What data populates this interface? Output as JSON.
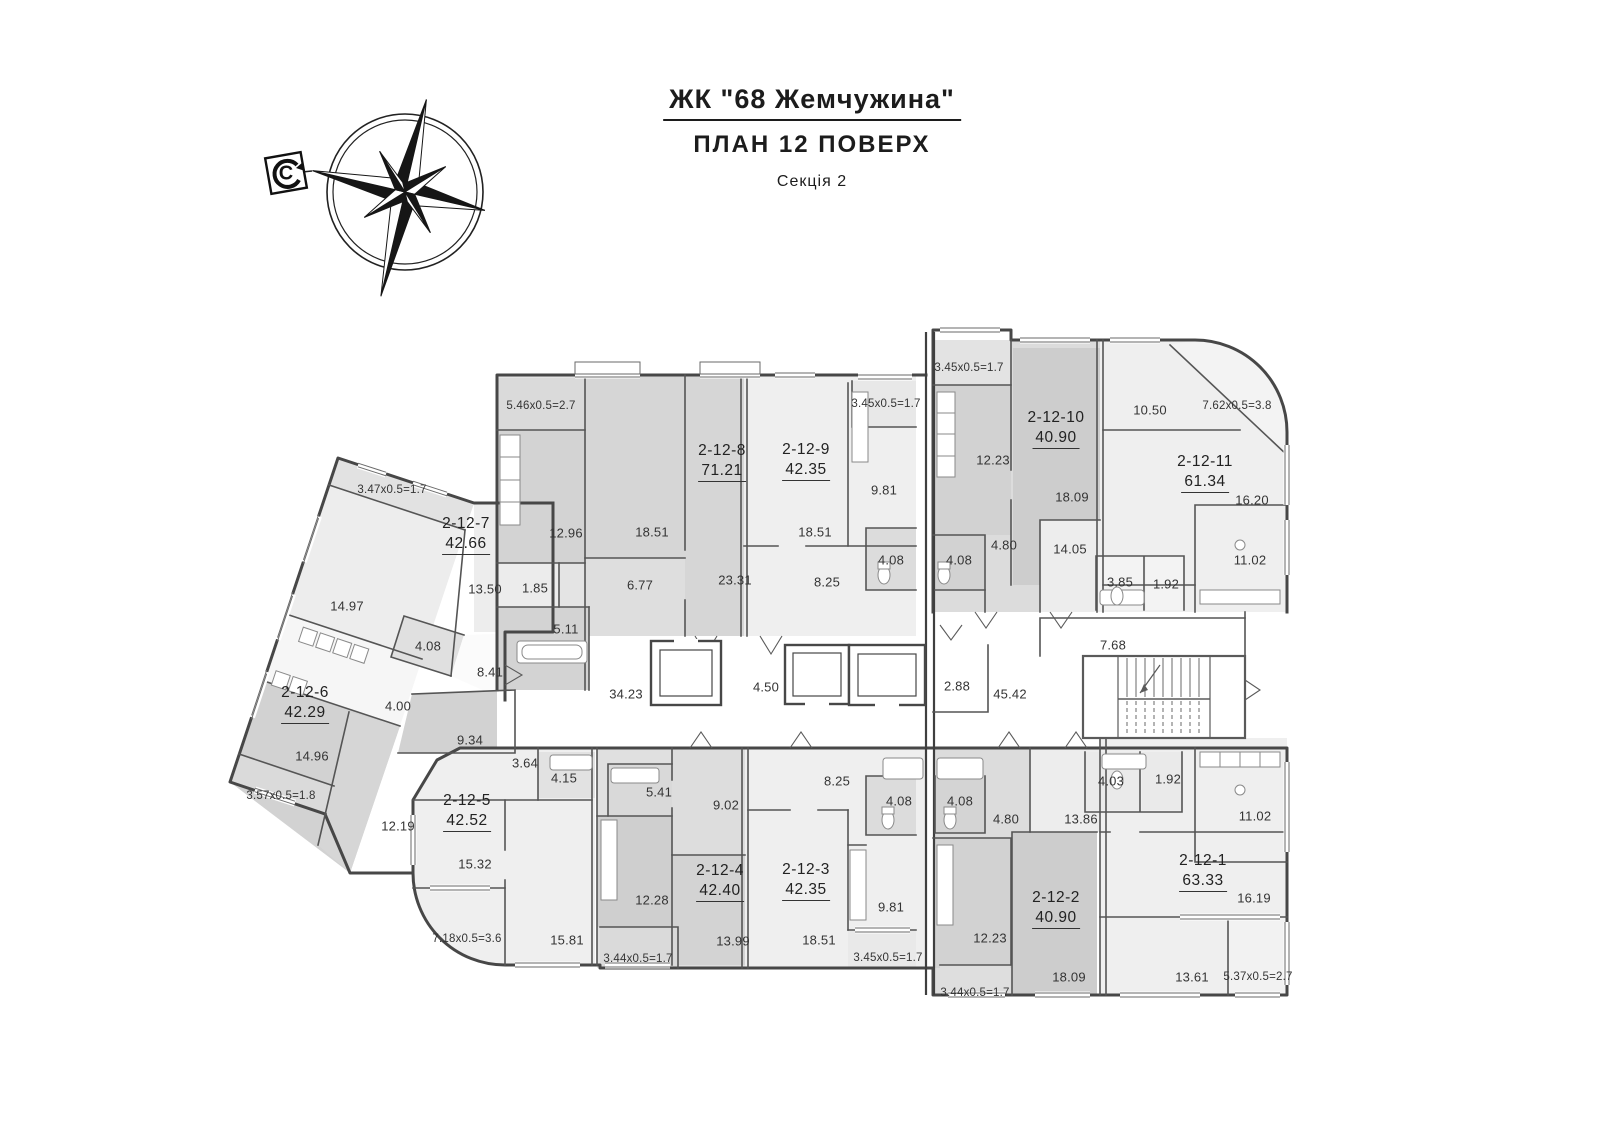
{
  "title": {
    "project": "ЖК \"68 Жемчужина\"",
    "plan": "ПЛАН 12 ПОВЕРХ",
    "section": "Секція 2"
  },
  "compass": {
    "north_label": "С"
  },
  "colors": {
    "wall": "#4a4a4a",
    "room_light": "#efefef",
    "room_mid": "#e0e0e0",
    "room_dark": "#d2d2d2",
    "background": "#ffffff",
    "text": "#343434"
  },
  "common_labels": [
    {
      "v": "34.23",
      "x": 626,
      "y": 694
    },
    {
      "v": "4.50",
      "x": 766,
      "y": 687
    },
    {
      "v": "2.88",
      "x": 957,
      "y": 686
    },
    {
      "v": "45.42",
      "x": 1010,
      "y": 694
    },
    {
      "v": "7.68",
      "x": 1113,
      "y": 645
    }
  ],
  "apartments": [
    {
      "id": "2-12-1",
      "area": "63.33",
      "x": 1203,
      "y": 872,
      "rooms": [
        {
          "v": "13.86",
          "x": 1081,
          "y": 819
        },
        {
          "v": "4.03",
          "x": 1111,
          "y": 781
        },
        {
          "v": "1.92",
          "x": 1168,
          "y": 779
        },
        {
          "v": "11.02",
          "x": 1255,
          "y": 816
        },
        {
          "v": "16.19",
          "x": 1254,
          "y": 898
        },
        {
          "v": "13.61",
          "x": 1192,
          "y": 977
        }
      ],
      "balconies": [
        {
          "v": "5.37x0.5=2.7",
          "x": 1258,
          "y": 977
        }
      ]
    },
    {
      "id": "2-12-2",
      "area": "40.90",
      "x": 1056,
      "y": 909,
      "rooms": [
        {
          "v": "4.08",
          "x": 960,
          "y": 801
        },
        {
          "v": "4.80",
          "x": 1006,
          "y": 819
        },
        {
          "v": "12.23",
          "x": 990,
          "y": 938
        },
        {
          "v": "18.09",
          "x": 1069,
          "y": 977
        }
      ],
      "balconies": [
        {
          "v": "3.44x0.5=1.7",
          "x": 975,
          "y": 993
        }
      ]
    },
    {
      "id": "2-12-3",
      "area": "42.35",
      "x": 806,
      "y": 881,
      "rooms": [
        {
          "v": "8.25",
          "x": 837,
          "y": 781
        },
        {
          "v": "4.08",
          "x": 899,
          "y": 801
        },
        {
          "v": "9.81",
          "x": 891,
          "y": 907
        },
        {
          "v": "18.51",
          "x": 819,
          "y": 940
        }
      ],
      "balconies": [
        {
          "v": "3.45x0.5=1.7",
          "x": 888,
          "y": 958
        }
      ]
    },
    {
      "id": "2-12-4",
      "area": "42.40",
      "x": 720,
      "y": 882,
      "rooms": [
        {
          "v": "5.41",
          "x": 659,
          "y": 792
        },
        {
          "v": "9.02",
          "x": 726,
          "y": 805
        },
        {
          "v": "12.28",
          "x": 652,
          "y": 900
        },
        {
          "v": "13.99",
          "x": 733,
          "y": 941
        }
      ],
      "balconies": [
        {
          "v": "3.44x0.5=1.7",
          "x": 638,
          "y": 959
        }
      ]
    },
    {
      "id": "2-12-5",
      "area": "42.52",
      "x": 467,
      "y": 812,
      "rooms": [
        {
          "v": "3.64",
          "x": 525,
          "y": 763
        },
        {
          "v": "4.15",
          "x": 564,
          "y": 778
        },
        {
          "v": "15.32",
          "x": 475,
          "y": 864
        },
        {
          "v": "15.81",
          "x": 567,
          "y": 940
        }
      ],
      "balconies": [
        {
          "v": "7.18x0.5=3.6",
          "x": 467,
          "y": 939
        }
      ]
    },
    {
      "id": "2-12-6",
      "area": "42.29",
      "x": 305,
      "y": 704,
      "rooms": [
        {
          "v": "4.00",
          "x": 398,
          "y": 706
        },
        {
          "v": "9.34",
          "x": 470,
          "y": 740
        },
        {
          "v": "14.96",
          "x": 312,
          "y": 756
        },
        {
          "v": "12.19",
          "x": 398,
          "y": 826
        }
      ],
      "balconies": [
        {
          "v": "3.57x0.5=1.8",
          "x": 281,
          "y": 796
        }
      ]
    },
    {
      "id": "2-12-7",
      "area": "42.66",
      "x": 466,
      "y": 535,
      "rooms": [
        {
          "v": "14.97",
          "x": 347,
          "y": 606
        },
        {
          "v": "13.50",
          "x": 485,
          "y": 589
        },
        {
          "v": "4.08",
          "x": 428,
          "y": 646
        },
        {
          "v": "8.41",
          "x": 490,
          "y": 672
        }
      ],
      "balconies": [
        {
          "v": "3.47x0.5=1.7",
          "x": 392,
          "y": 490
        }
      ]
    },
    {
      "id": "2-12-8",
      "area": "71.21",
      "x": 722,
      "y": 462,
      "rooms": [
        {
          "v": "12.96",
          "x": 566,
          "y": 533
        },
        {
          "v": "18.51",
          "x": 652,
          "y": 532
        },
        {
          "v": "1.85",
          "x": 535,
          "y": 588
        },
        {
          "v": "5.11",
          "x": 566,
          "y": 629
        },
        {
          "v": "6.77",
          "x": 640,
          "y": 585
        },
        {
          "v": "23.31",
          "x": 735,
          "y": 580
        }
      ],
      "balconies": [
        {
          "v": "5.46x0.5=2.7",
          "x": 541,
          "y": 406
        }
      ]
    },
    {
      "id": "2-12-9",
      "area": "42.35",
      "x": 806,
      "y": 461,
      "rooms": [
        {
          "v": "18.51",
          "x": 815,
          "y": 532
        },
        {
          "v": "9.81",
          "x": 884,
          "y": 490
        },
        {
          "v": "4.08",
          "x": 891,
          "y": 560
        },
        {
          "v": "8.25",
          "x": 827,
          "y": 582
        }
      ],
      "balconies": [
        {
          "v": "3.45x0.5=1.7",
          "x": 886,
          "y": 404
        }
      ]
    },
    {
      "id": "2-12-10",
      "area": "40.90",
      "x": 1056,
      "y": 429,
      "rooms": [
        {
          "v": "12.23",
          "x": 993,
          "y": 460
        },
        {
          "v": "18.09",
          "x": 1072,
          "y": 497
        },
        {
          "v": "4.08",
          "x": 959,
          "y": 560
        },
        {
          "v": "4.80",
          "x": 1004,
          "y": 545
        }
      ],
      "balconies": [
        {
          "v": "3.45x0.5=1.7",
          "x": 969,
          "y": 368
        }
      ]
    },
    {
      "id": "2-12-11",
      "area": "61.34",
      "x": 1205,
      "y": 473,
      "rooms": [
        {
          "v": "10.50",
          "x": 1150,
          "y": 410
        },
        {
          "v": "16.20",
          "x": 1252,
          "y": 500
        },
        {
          "v": "14.05",
          "x": 1070,
          "y": 549
        },
        {
          "v": "3.85",
          "x": 1120,
          "y": 582
        },
        {
          "v": "1.92",
          "x": 1166,
          "y": 584
        },
        {
          "v": "11.02",
          "x": 1250,
          "y": 560
        }
      ],
      "balconies": [
        {
          "v": "7.62x0.5=3.8",
          "x": 1237,
          "y": 406
        }
      ]
    }
  ]
}
